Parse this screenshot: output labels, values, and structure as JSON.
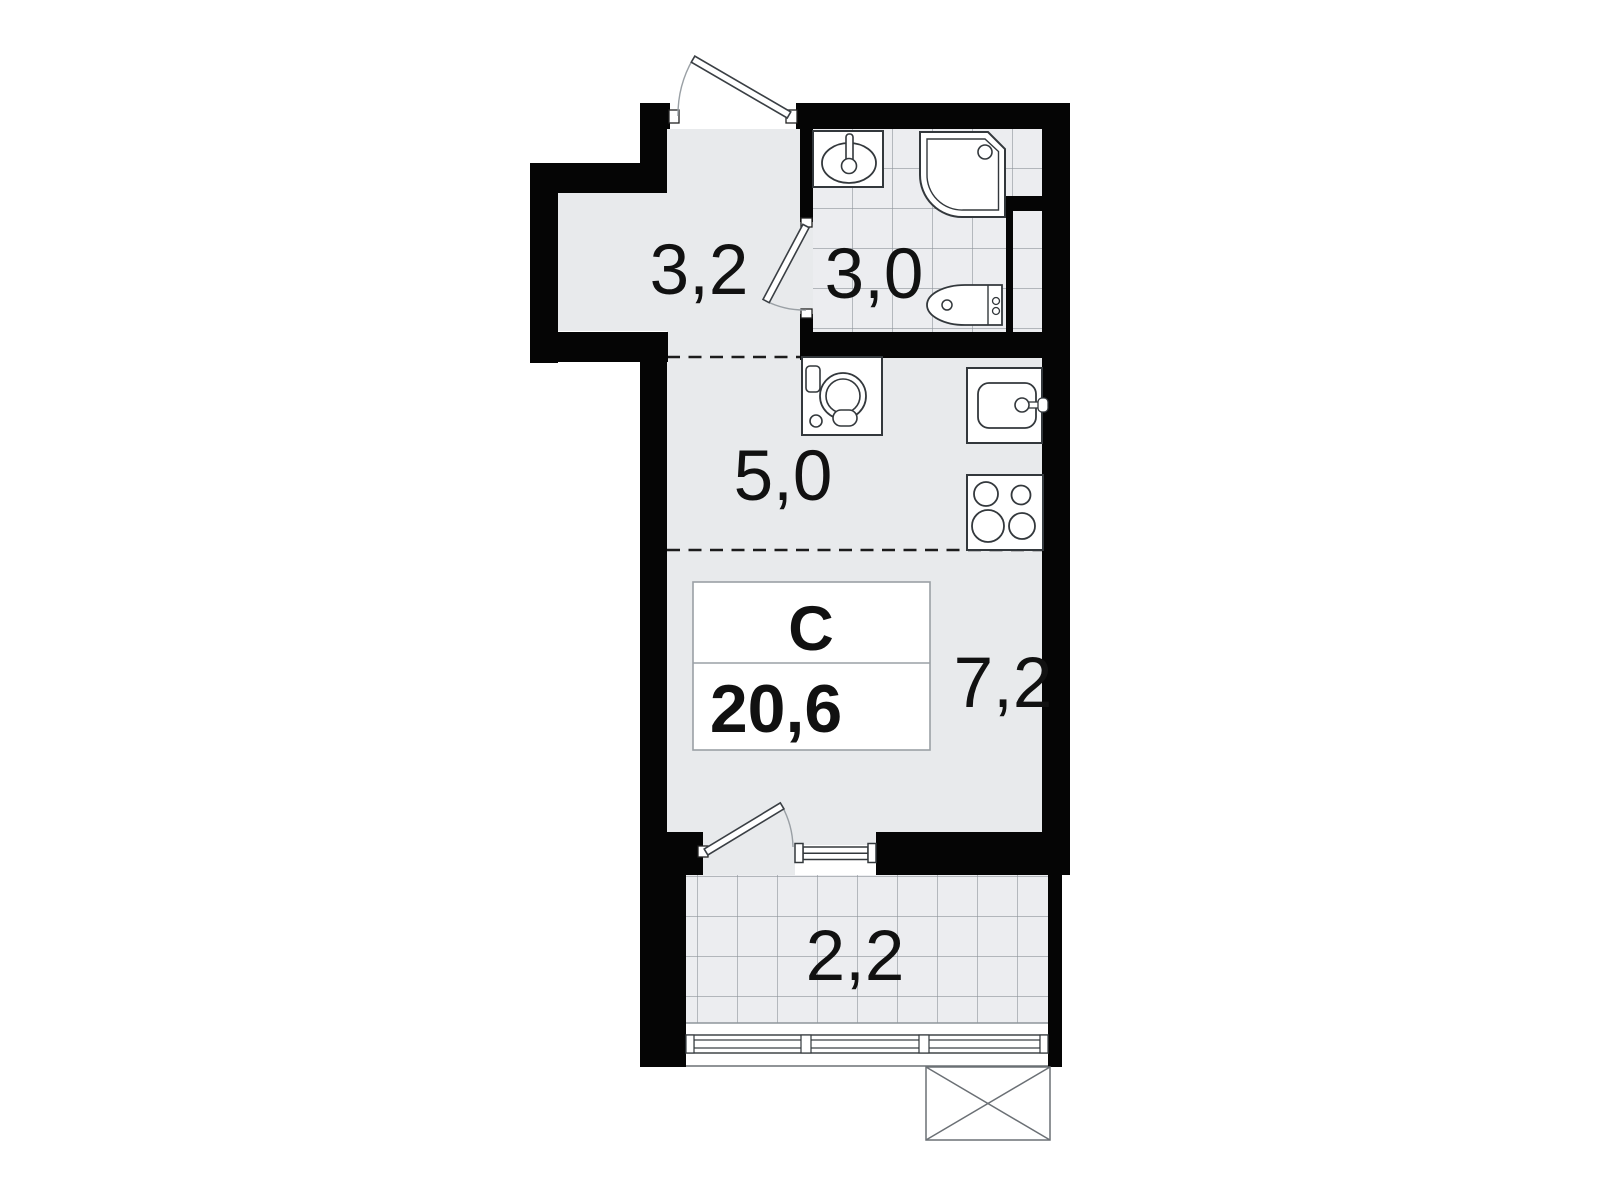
{
  "plan": {
    "title": "Studio apartment floor plan",
    "info_box": {
      "type_label": "С",
      "total_area": "20,6"
    },
    "rooms": [
      {
        "name": "hallway",
        "area": "3,2"
      },
      {
        "name": "bathroom",
        "area": "3,0"
      },
      {
        "name": "kitchen",
        "area": "5,0"
      },
      {
        "name": "living-room",
        "area": "7,2"
      },
      {
        "name": "balcony",
        "area": "2,2"
      }
    ],
    "fixtures": [
      "entrance-door",
      "bathroom-door",
      "balcony-door",
      "bathroom-sink",
      "shower-cabin",
      "toilet",
      "washing-machine",
      "kitchen-sink",
      "cooktop",
      "window",
      "balcony-glazing",
      "ac-unit-platform"
    ],
    "colors": {
      "wall": "#050505",
      "floor": "#e8eaec",
      "tile_bg": "#ecedf0",
      "tile_line": "#8e959b",
      "fixture_outline": "#33383c",
      "swing_arc": "#9aa0a5",
      "label_text": "#111111",
      "box_border": "#9aa0a5"
    }
  }
}
